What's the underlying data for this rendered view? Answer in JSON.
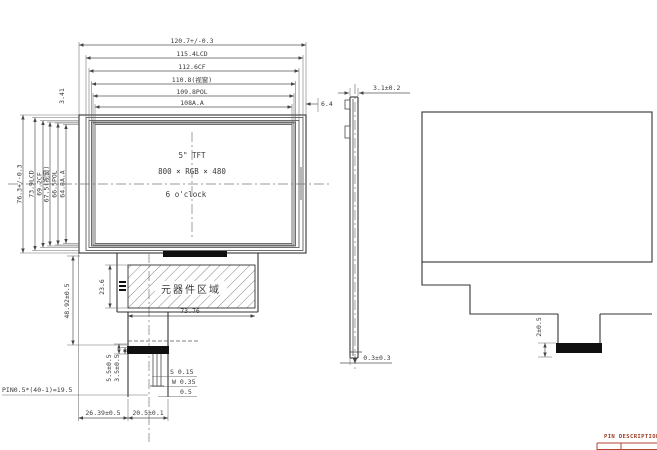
{
  "front_view": {
    "width_dims": [
      "120.7+/-0.3",
      "115.4LCD",
      "112.6CF",
      "110.8(视窗)",
      "109.8POL",
      "108A.A"
    ],
    "height_dims": [
      "76.3+/-0.3",
      "73.9LCD",
      "69.2CF",
      "67.5(视窗)",
      "66.5POL",
      "64.8A.A"
    ],
    "right_gap": "6.4",
    "top_gap": "3.41",
    "panel": {
      "size": "5\" TFT",
      "resolution": "800 × RGB × 480",
      "viewing": "6 o'clock"
    },
    "component_area": {
      "label": "元器件区域",
      "width": "73.76",
      "height": "23.6"
    },
    "fpc": {
      "length": "48.92±0.5",
      "dim_a": "5.5±0.5",
      "dim_b": "3.5±0.5",
      "pin_spec": "PIN0.5*(40-1)=19.5",
      "pad_space": "S 0.15",
      "pad_width": "W 0.35",
      "pad_pitch": "0.5",
      "bottom_left": "26.39±0.5",
      "bottom_right": "20.5±0.1"
    }
  },
  "side_view": {
    "thickness": "3.1±0.2",
    "gap": "0.3±0.3"
  },
  "rear_view": {
    "connector_dim": "2±0.5"
  },
  "pin_table": {
    "title": "PIN DESCRIPTION"
  }
}
